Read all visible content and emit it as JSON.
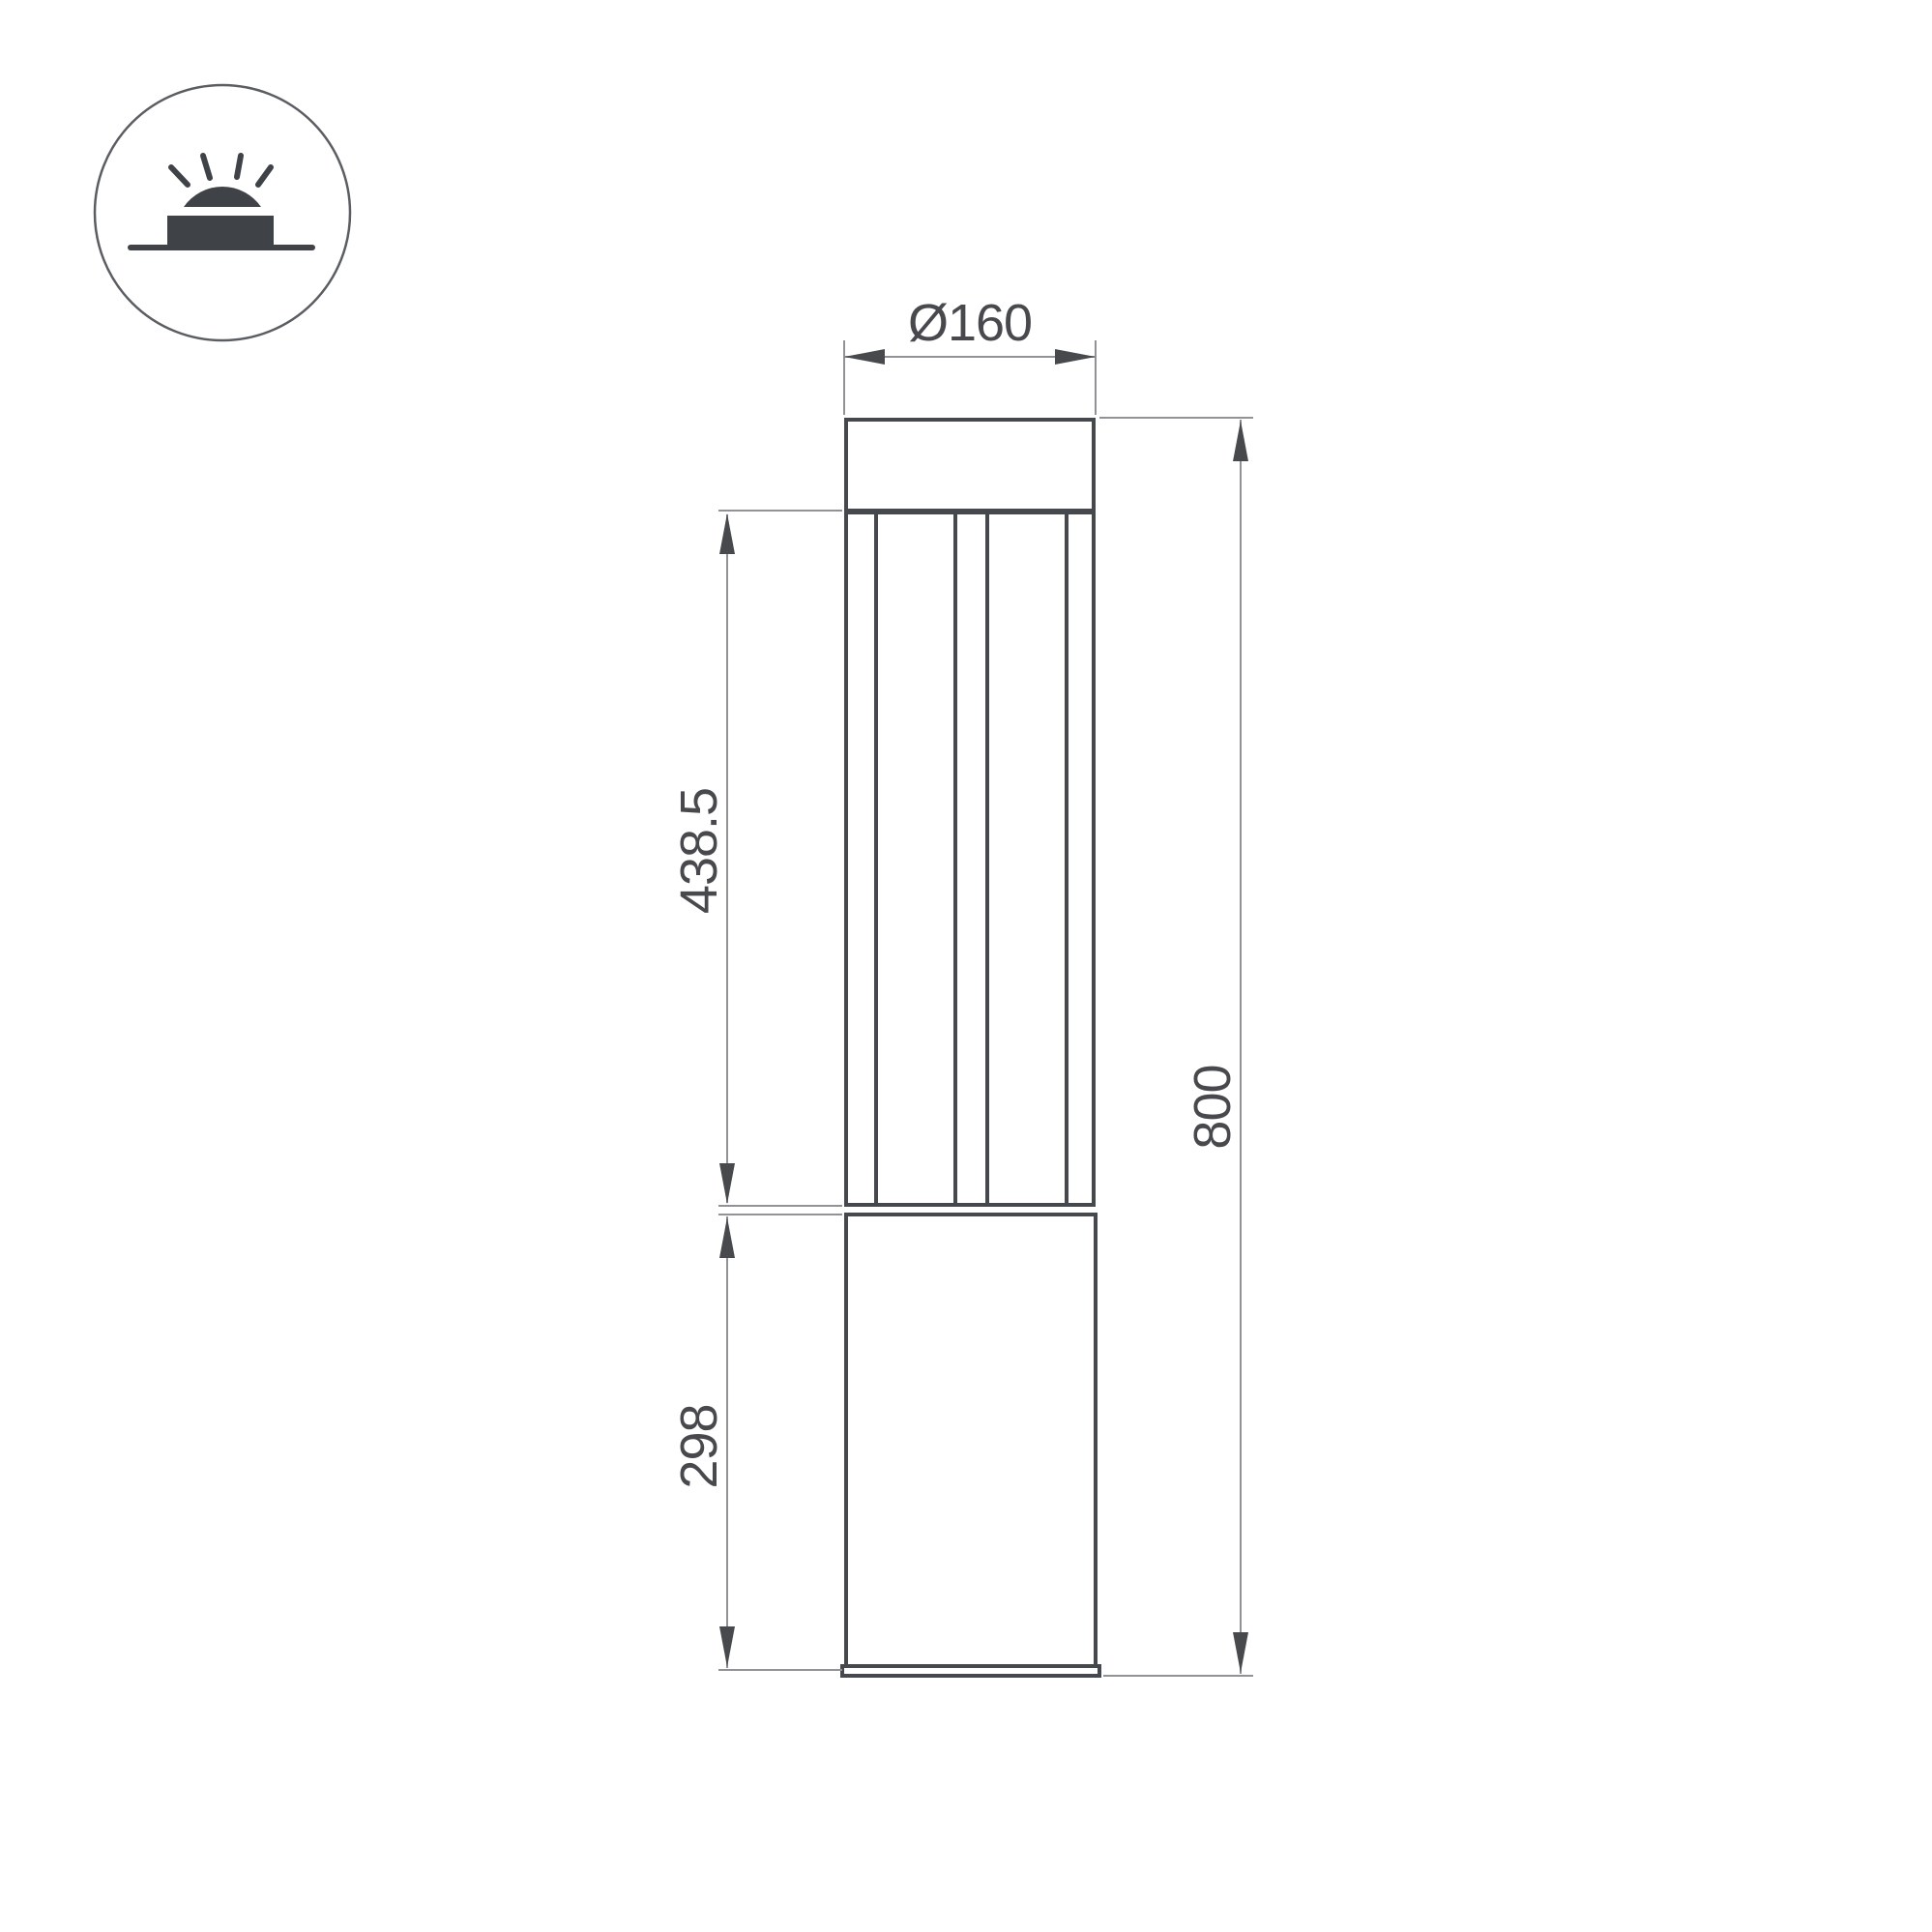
{
  "meta": {
    "title": "Bollard luminaire dimensional drawing",
    "view": "front elevation"
  },
  "icon": {
    "name": "ground-surface-light-icon",
    "description": "surface mounted luminaire emitting light upward"
  },
  "dimensions": {
    "diameter": "Ø160",
    "upper_section_height": "438.5",
    "base_section_height": "298",
    "total_height": "800"
  },
  "colors": {
    "outline": "#45484c",
    "thin_line": "#909296",
    "text": "#47494d",
    "icon": "#3f4246",
    "background": "#ffffff"
  }
}
